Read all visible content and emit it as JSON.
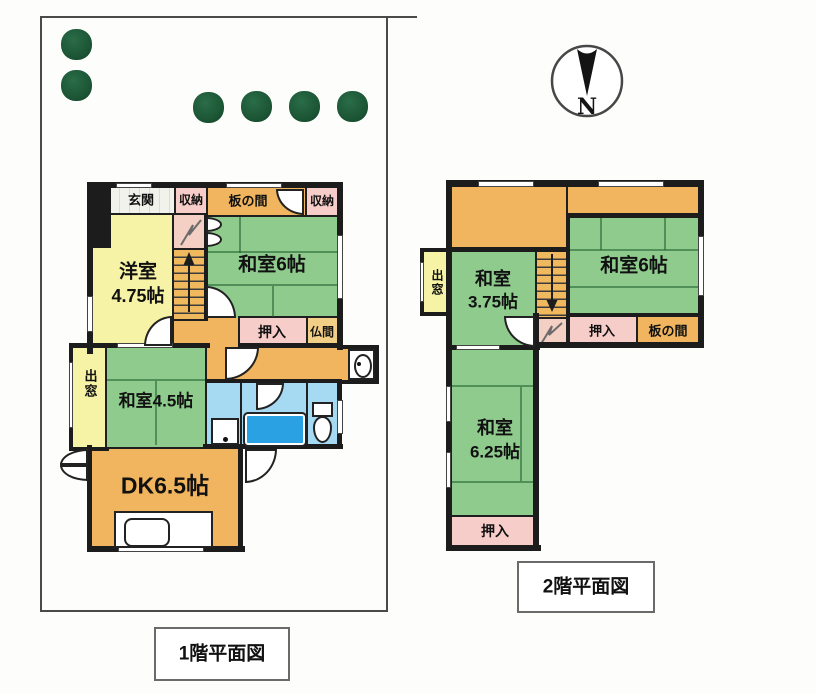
{
  "document": {
    "type": "floor-plan-scan"
  },
  "colors": {
    "tatami_green": "#8ecb8d",
    "wood_orange": "#f0b55e",
    "closet_pink": "#f7cdc9",
    "western_yellow": "#f7f3a6",
    "wet_area_blue": "#a6d9f2",
    "bathtub_blue": "#29a1e3",
    "butsuma_tan": "#f2cf86",
    "wall_black": "#1c1c1c",
    "tree_green": "#1b5434"
  },
  "compass": {
    "letter": "N"
  },
  "floor1": {
    "title": "1階平面図",
    "rooms": {
      "genkan": "玄関",
      "closet_top_left": "収納",
      "itanoma": "板の間",
      "closet_top_right": "収納",
      "yoshitsu_name": "洋室",
      "yoshitsu_size": "4.75帖",
      "washitsu6": "和室6帖",
      "oshiire": "押入",
      "butsuma": "仏間",
      "demado": "出窓",
      "washitsu45": "和室4.5帖",
      "dk": "DK6.5帖"
    }
  },
  "floor2": {
    "title": "2階平面図",
    "rooms": {
      "demado": "出窓",
      "washitsu375_name": "和室",
      "washitsu375_size": "3.75帖",
      "washitsu6": "和室6帖",
      "oshiire_right": "押入",
      "itanoma": "板の間",
      "washitsu625_name": "和室",
      "washitsu625_size": "6.25帖",
      "oshiire_bottom": "押入"
    }
  }
}
